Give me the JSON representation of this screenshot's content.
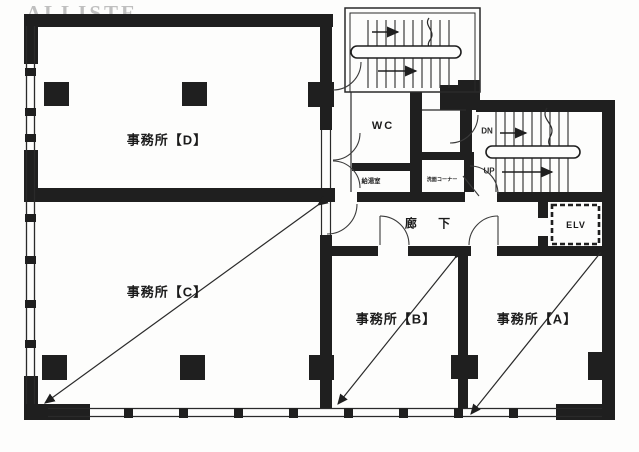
{
  "watermark": "ALLISTE",
  "colors": {
    "ink": "#1f1f1f",
    "paper": "#fdfdfc",
    "watermark": "#bfbfbf"
  },
  "rooms": {
    "office_d": {
      "label": "事務所【D】"
    },
    "office_c": {
      "label": "事務所【C】"
    },
    "office_b": {
      "label": "事務所【B】"
    },
    "office_a": {
      "label": "事務所【A】"
    },
    "wc": {
      "label": "WC"
    },
    "corridor": {
      "label": "廊 下"
    },
    "elevator": {
      "label": "ELV"
    },
    "kitchenette": {
      "label": "給湯室"
    },
    "washcorner": {
      "label": "洗面コーナー"
    }
  },
  "stairs": {
    "down_label": "DN",
    "up_label": "UP"
  }
}
